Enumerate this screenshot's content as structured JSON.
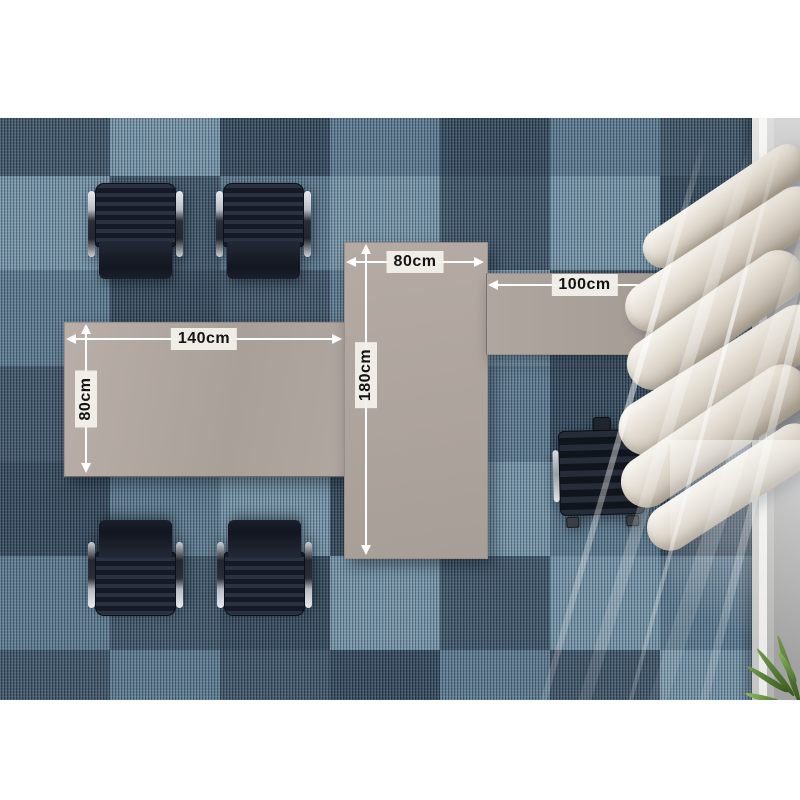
{
  "scene": {
    "kind": "top-down office desk layout with dimension annotations",
    "objects": [
      "carpet",
      "office-chairs",
      "desks",
      "executive-chair",
      "curtain",
      "window-floor-strip",
      "plant"
    ]
  },
  "desks": {
    "left": {
      "width_label": "140cm",
      "depth_label": "80cm"
    },
    "center": {
      "width_label": "80cm",
      "length_label": "180cm"
    },
    "side": {
      "width_label": "100cm",
      "depth_label": "40cm"
    }
  },
  "colors": {
    "desk_top": "#b2a7a1",
    "carpet_base": "#4b657a",
    "carpet_light_tile": "#a1c5d7",
    "carpet_dark_tile": "#1a2c3e",
    "chair_body": "#1a202c",
    "chrome": "#c9ced3",
    "curtain": "#e4ddd2",
    "floor_strip": "#a2a2a2",
    "label_bg": "#f2efe9",
    "label_text": "#141414",
    "arrow": "#ffffff"
  }
}
